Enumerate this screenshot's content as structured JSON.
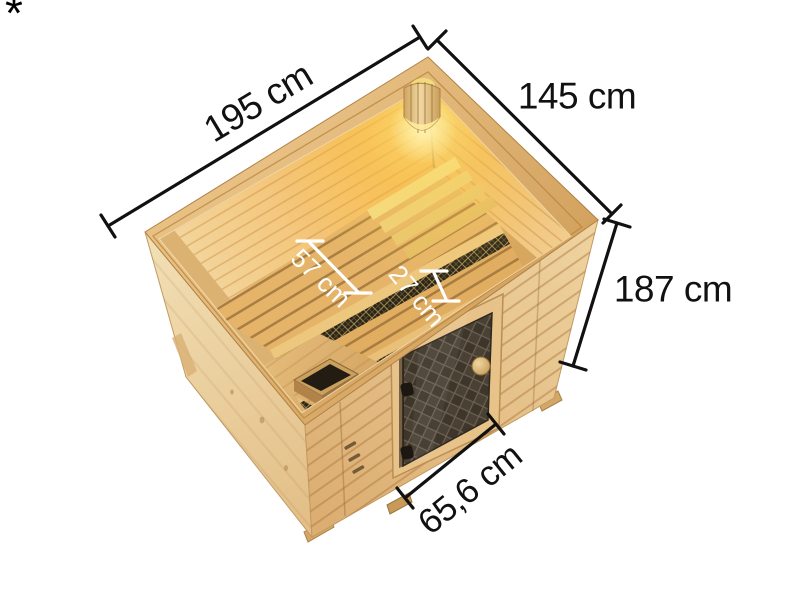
{
  "page": {
    "background": "#ffffff",
    "footnote_marker": "*"
  },
  "figure": {
    "subject": "sauna-top-view-dimension-diagram",
    "palette": {
      "wood_light": "#f0dcae",
      "wood_mid": "#e3bb82",
      "wood_cap": "#d5a463",
      "wood_bench": "#e5b469",
      "interior_glow": "#ffe98c",
      "door_glass": "#4a4135",
      "dimension_line": "#111111",
      "interior_dimension_line": "#ffffff"
    },
    "dimensions": [
      {
        "id": "outer-width",
        "label": "195 cm"
      },
      {
        "id": "outer-depth",
        "label": "145 cm"
      },
      {
        "id": "outer-height",
        "label": "187 cm"
      },
      {
        "id": "door-width",
        "label": "65,6 cm"
      },
      {
        "id": "bench-depth-upper",
        "label": "57 cm"
      },
      {
        "id": "bench-depth-lower",
        "label": "27 cm"
      }
    ]
  }
}
